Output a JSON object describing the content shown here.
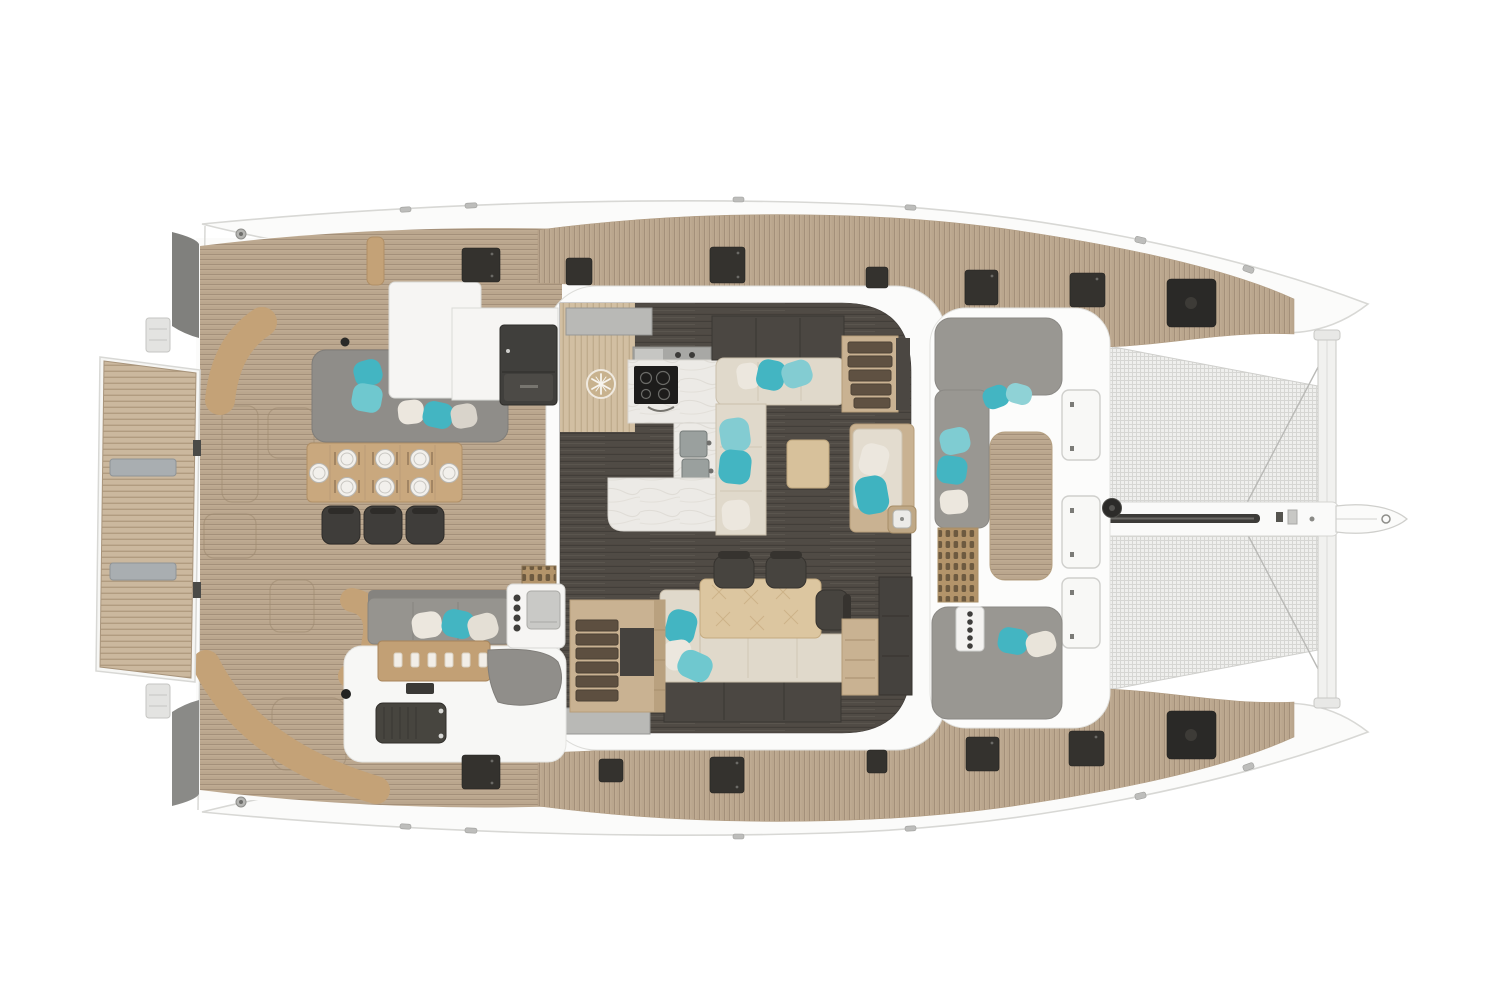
{
  "title": "Catamaran yacht deck and saloon floor plan, top-down view, bow to the right",
  "vessel": {
    "type": "sailing catamaran",
    "view": "top-down deck plan render",
    "bow_direction": "right",
    "stern_direction": "left"
  },
  "areas": {
    "swim_platform": {
      "label": "Teak swim platform with two grip pads"
    },
    "aft_cockpit": {
      "label": "Aft cockpit with dining table for 8, grey lounge, bar module and curved benches"
    },
    "salon": {
      "label": "Main salon with galley, L-shaped sofa, coffee table, dining table and companionway stairs"
    },
    "galley": {
      "label": "Galley with fridge-freezer, induction cooktop, hood and double sink in marble counter"
    },
    "side_deck_port": {
      "label": "Port side deck with flush hatches"
    },
    "side_deck_starboard": {
      "label": "Starboard side deck with flush hatches"
    },
    "forward_cockpit": {
      "label": "Forward cockpit with grey loungers, teak bench and control panel"
    },
    "foredeck": {
      "label": "Foredeck with three locker hatches and windlass"
    },
    "trampoline_port": {
      "label": "Port bow trampoline net"
    },
    "trampoline_starboard": {
      "label": "Starboard bow trampoline net"
    },
    "bowsprit": {
      "label": "Central bow walkway with anchor track, crossbeam and bowsprit fin"
    }
  },
  "counts": {
    "dining_place_settings_cockpit": 8,
    "cockpit_dining_chairs": 3,
    "salon_dining_chairs": 3,
    "foredeck_hatch_panels": 3,
    "deck_hatches_port": 7,
    "deck_hatches_starboard": 7,
    "trampolines": 2,
    "hull_stairs": 2
  },
  "colors": {
    "background": "#ffffff",
    "hull_white": "#fbfbfa",
    "outline_grey": "#d8d8d5",
    "teak": "#bfab92",
    "teak_line": "#a4907a",
    "platform_teak": "#cbb89e",
    "bench_tan": "#c4a277",
    "table_wood": "#c9a87e",
    "salon_table_wood": "#dcc6a0",
    "salon_floor": "#4f4a45",
    "galley_wood": "#d2bfa2",
    "marble": "#eceae6",
    "sofa_cream": "#e0d9cb",
    "lounge_grey": "#96948f",
    "carpet_grey": "#908e8a",
    "pillow_teal": "#43b5c2",
    "pillow_teal_light": "#83ccd2",
    "pillow_white": "#ece7de",
    "cabinet_dark": "#4b4742",
    "hatch_dark": "#34322e",
    "mesh_grey": "#efefed",
    "mesh_line": "#d6d6d3"
  }
}
